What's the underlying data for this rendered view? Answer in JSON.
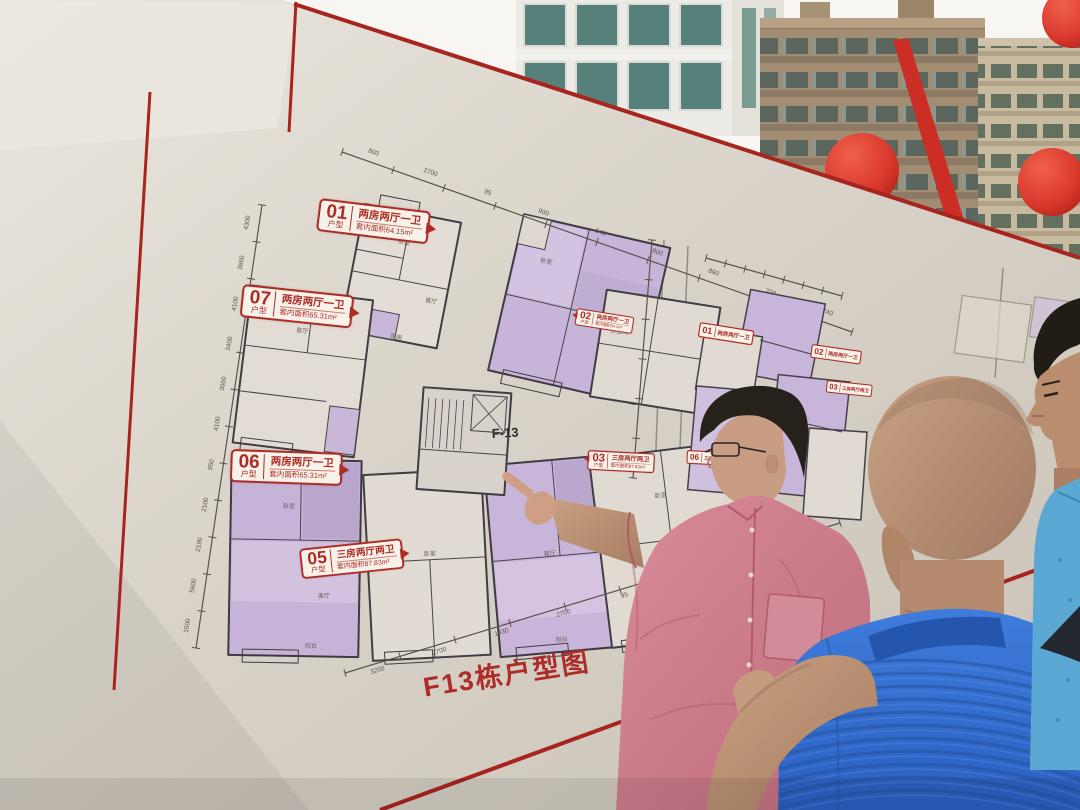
{
  "photo": {
    "board1": {
      "title": "F13栋户型图",
      "core_label": "F-13",
      "note": "注：1 三房五厅户型",
      "unit_type_caption": "户型",
      "units": [
        {
          "id": "01",
          "name": "两房两厅一卫",
          "area": "套内面积64.15m²"
        },
        {
          "id": "02",
          "name": "两房两厅一卫",
          "area": "套内面积64.2m²"
        },
        {
          "id": "03",
          "name": "三房两厅两卫",
          "area": "套内面积87.83m²"
        },
        {
          "id": "04",
          "name": "",
          "area": ""
        },
        {
          "id": "05",
          "name": "三房两厅两卫",
          "area": "套内面积87.83m²"
        },
        {
          "id": "06",
          "name": "两房两厅一卫",
          "area": "套内面积65.31m²"
        },
        {
          "id": "07",
          "name": "两房两厅一卫",
          "area": "套内面积65.31m²"
        }
      ],
      "dims_left": [
        "4300",
        "3660",
        "4100",
        "3400",
        "3060",
        "4100",
        "950",
        "2100",
        "2190",
        "5600",
        "1500"
      ],
      "dims_top": [
        "800",
        "2700",
        "95",
        "900",
        "540",
        "800",
        "890",
        "700",
        "740"
      ],
      "dims_bottom": [
        "3200",
        "2700",
        "1430",
        "2700",
        "95",
        "1340",
        "510",
        "660"
      ],
      "room_labels": [
        "卧室",
        "客厅",
        "餐厅",
        "厨房",
        "阳台",
        "卫生间"
      ]
    },
    "board2": {
      "labels": [
        {
          "id": "01",
          "text": "两房两厅一卫"
        },
        {
          "id": "02",
          "text": "两房两厅一卫"
        },
        {
          "id": "03",
          "text": "三房两厅两卫"
        },
        {
          "id": "06",
          "text": "三房两厅两卫"
        }
      ]
    },
    "colors": {
      "board_bg": "#d8d2c8",
      "accent_red": "#a8241f",
      "label_red": "#ae2c25",
      "unit_purple": "#c6b4d8",
      "wall_line": "#3f3942",
      "balloon_red": "#d8382c",
      "pink_shirt": "#cf7e8d",
      "blue_polo": "#2f6fd0",
      "light_blue_polo": "#5ba8d4",
      "skin": "#c49a7f"
    }
  }
}
